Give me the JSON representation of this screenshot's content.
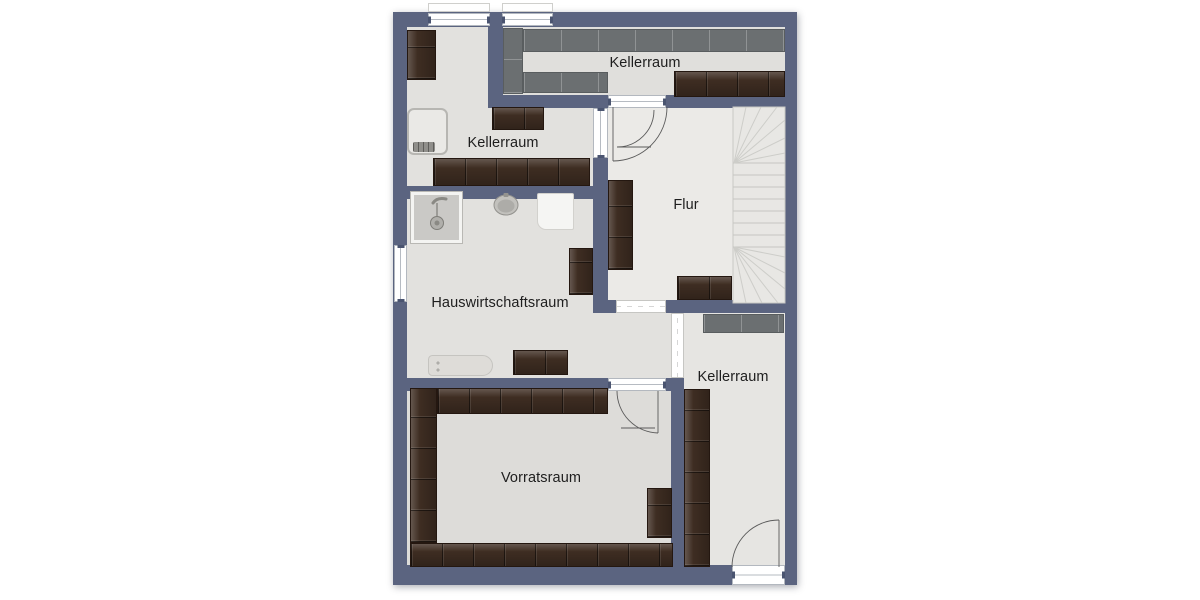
{
  "plan": {
    "type": "floor-plan",
    "language": "de",
    "rooms": [
      {
        "id": "kellerraum-top",
        "label": "Kellerraum"
      },
      {
        "id": "kellerraum-upper-left",
        "label": "Kellerraum"
      },
      {
        "id": "flur",
        "label": "Flur"
      },
      {
        "id": "hauswirtschaftsraum",
        "label": "Hauswirtschaftsraum"
      },
      {
        "id": "kellerraum-right",
        "label": "Kellerraum"
      },
      {
        "id": "vorratsraum",
        "label": "Vorratsraum"
      }
    ],
    "features": [
      "stairs-winder",
      "shower",
      "sink",
      "washing-machine",
      "water-heater",
      "ironing-board",
      "dark-shelving",
      "gray-shelving",
      "doors-with-swing-arcs",
      "windows"
    ],
    "colors": {
      "wall": "#5b6480",
      "floor": "#e2e1de",
      "floor-flur": "#ebeae7",
      "floor-top-right": "#e0dfdc",
      "floor-right": "#e6e5e2",
      "floor-vorrat": "#dddcd9",
      "shelf-dark-brown": "#3e2d22",
      "shelf-gray": "#6b6f71",
      "stairs": "#e8e7e4",
      "label-text": "#1e1e1e",
      "window": "#ffffff"
    }
  }
}
